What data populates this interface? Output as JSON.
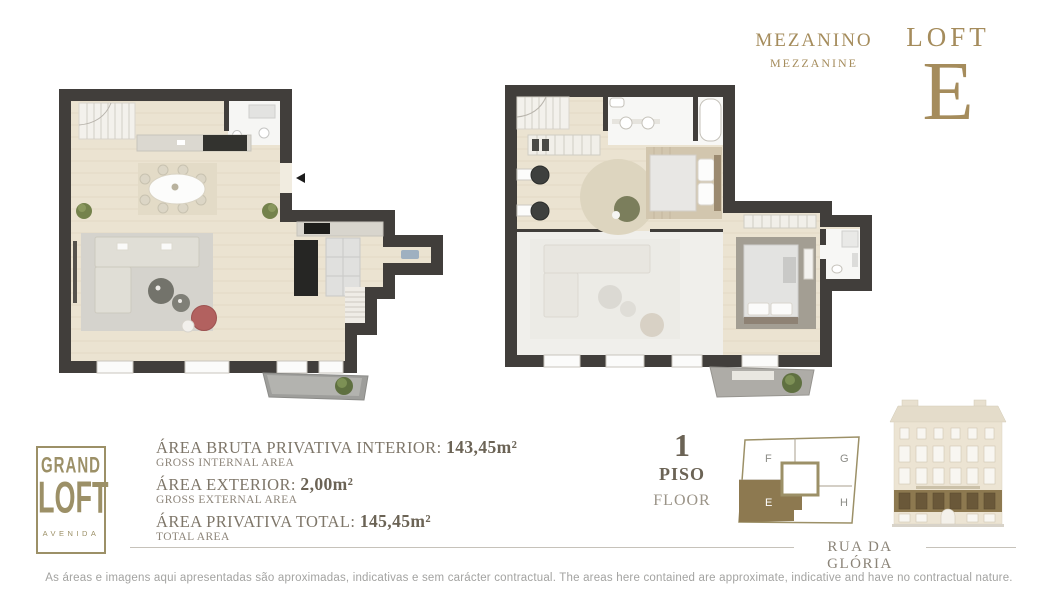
{
  "plan_label": {
    "pt": "MEZANINO",
    "en": "MEZZANINE"
  },
  "title_block": {
    "loft_word": "LOFT",
    "loft_letter": "E"
  },
  "logo": {
    "top": "GRAND",
    "middle": "LOFT",
    "bottom": "AVENIDA"
  },
  "areas": [
    {
      "label_pt": "ÁREA BRUTA PRIVATIVA INTERIOR:",
      "value": "143,45m²",
      "label_en": "GROSS INTERNAL AREA"
    },
    {
      "label_pt": "ÁREA EXTERIOR:",
      "value": "2,00m²",
      "label_en": "GROSS EXTERNAL AREA"
    },
    {
      "label_pt": "ÁREA PRIVATIVA TOTAL:",
      "value": "145,45m²",
      "label_en": "TOTAL AREA"
    }
  ],
  "floor_indicator": {
    "number": "1",
    "label_pt": "PISO",
    "label_en": "FLOOR"
  },
  "unit_diagram": {
    "unit_f": "F",
    "unit_g": "G",
    "unit_e": "E",
    "unit_h": "H",
    "highlighted_unit": "E"
  },
  "street_label": "RUA DA GLÓRIA",
  "disclaimer": "As áreas e imagens aqui apresentadas são aproximadas, indicativas e sem carácter contractual. The areas here contained are approximate, indicative and have no contractual nature.",
  "colors": {
    "gold": "#a58c5c",
    "logo_gold": "#9c9067",
    "taupe_text": "#7e7669",
    "dark_taupe": "#6b6355",
    "unit_highlight": "#8d7950",
    "wall": "#413e3b",
    "floor": "#ebe3d1",
    "accent_red": "#b2615f"
  }
}
